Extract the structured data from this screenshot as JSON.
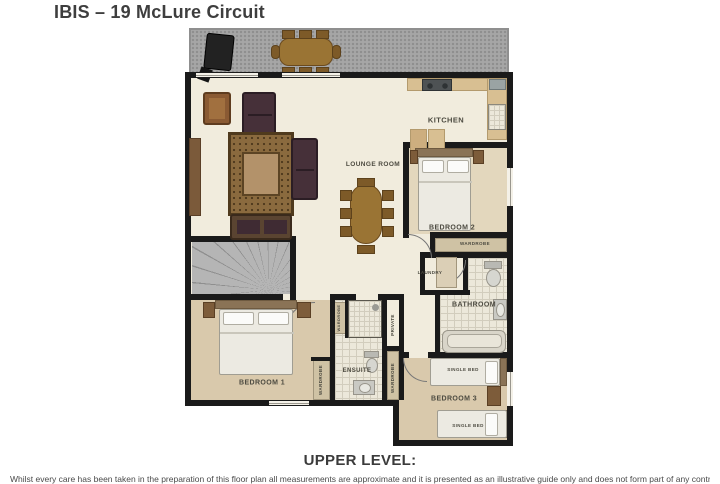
{
  "title": "IBIS – 19 McLure Circuit",
  "plan": {
    "rooms": {
      "kitchen": "KITCHEN",
      "lounge_room": "LOUNGE ROOM",
      "bedroom2": "BEDROOM 2",
      "bedroom1": "BEDROOM 1",
      "bedroom3": "BEDROOM 3",
      "bathroom": "BATHROOM",
      "ensuite": "ENSUITE",
      "laundry": "LAUNDRY",
      "private": "PRIVATE"
    },
    "storage": {
      "wardrobe_bedroom2": "WARDROBE",
      "wardrobe_bedroom1": "WARDROBE",
      "wardrobe_hall": "WARDROBE",
      "wardrobe_ensuite": "WARDROBE"
    },
    "furniture": {
      "single_bed_top": "SINGLE BED",
      "single_bed_bottom": "SINGLE BED"
    },
    "colors": {
      "wall": "#1a1a1a",
      "floor": "#f1ecdd",
      "carpet": "#d9c9ac",
      "deck": "#a6a6a6",
      "counter": "#d8bf92",
      "tile": "#ece8da"
    }
  },
  "footer": {
    "heading": "UPPER LEVEL:",
    "fineprint": "Whilst every care has been taken in the preparation of this floor plan all measurements are approximate and it is presented as an illustrative guide only and does not form part of any contract or warranty."
  }
}
